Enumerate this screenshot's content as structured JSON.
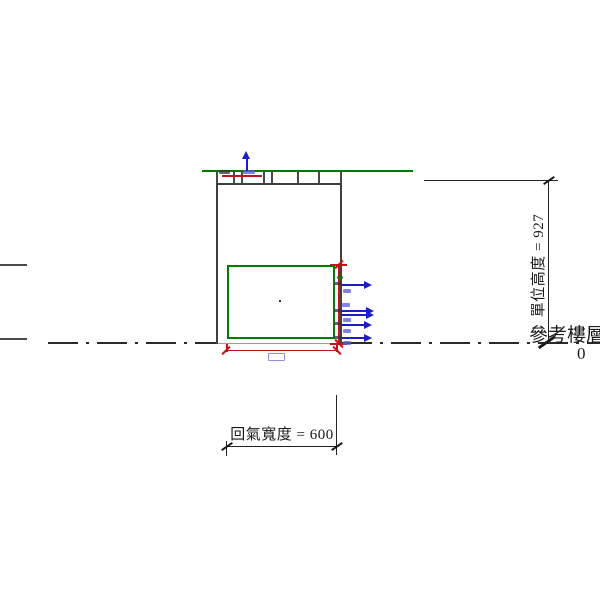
{
  "drawing": {
    "type": "hvac-unit-elevation",
    "level": {
      "name": "參考樓層",
      "elevation": "0"
    },
    "dimensions": {
      "unit_height_label": "單位高度 = 927",
      "return_width_label": "回氣寬度 = 600"
    },
    "colors": {
      "ceiling_line": "#007d00",
      "return_opening": "#007d00",
      "unit_outline": "#3f3f3f",
      "flow_arrows": "#1c1ccc",
      "temp_dimension": "#c41414",
      "annotation": "#1a1a1a"
    },
    "icons": {
      "flow_arrow_count_right": 5,
      "flow_arrow_up_count": 1
    }
  }
}
